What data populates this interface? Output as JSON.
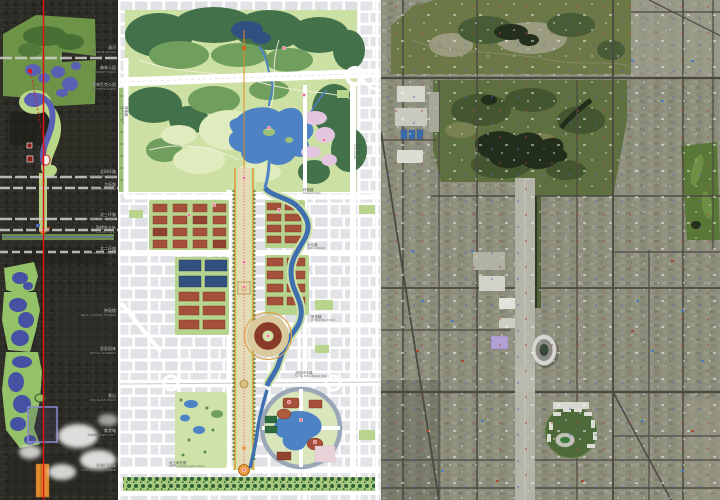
{
  "page": {
    "description": "Beijing central axis planning board: satellite axis strip, Olympic Green master plan, aerial photo"
  },
  "palette": {
    "axis_red": "#dd1414",
    "overlay_park_green": "#76a24c",
    "overlay_water_blue": "#5a61b5",
    "axis_corridor_green": "#b9d887",
    "plan_forest_green": "#42714a",
    "plan_lawn_green": "#cbe0a2",
    "plan_water_blue": "#4d82c4",
    "plan_building_red": "#a5503a",
    "plan_roof_navy": "#32507e",
    "blossom_pink": "#e2c5df",
    "axis_orange": "#e08a28",
    "stadium_ring_red": "#8a3a28",
    "tiananmen_square_orange": "#e08a2e",
    "forbidden_city_outline": "#8a8ad0",
    "satellite_park_green": "#5e6f40",
    "satellite_lake_dark": "#232d1c",
    "water_cube_purple": "#b2a2d4"
  },
  "left": {
    "name": "central axis satellite strip",
    "labels": [
      {
        "zh": "清河",
        "en": "QINGHE RIVER"
      },
      {
        "zh": "森林公园",
        "en": "FOREST PARK"
      },
      {
        "zh": "奥林匹克公园",
        "en": "OLYMPIC PARK"
      },
      {
        "zh": "北四环路",
        "en": "N.4TH RING ROAD"
      },
      {
        "zh": "北辰路",
        "en": "BEICHEN ROAD"
      },
      {
        "zh": "北三环路",
        "en": "N.3RD RING ROAD"
      },
      {
        "zh": "鼓楼外大街",
        "en": "GULOU AVE."
      },
      {
        "zh": "北二环路",
        "en": "N.2ND RING ROAD"
      },
      {
        "zh": "钟鼓楼",
        "en": "BELL & DRUM TOWER"
      },
      {
        "zh": "皇家园林",
        "en": "ROYAL GARDEN"
      },
      {
        "zh": "景山",
        "en": "JINGSHAN PARK"
      },
      {
        "zh": "紫禁城",
        "en": "FORBIDDEN CITY"
      },
      {
        "zh": "天安门广场",
        "en": "TIAN'ANMEN SQUARE"
      }
    ]
  },
  "middle": {
    "name": "Olympic Green master plan",
    "road_labels": [
      {
        "zh": "林萃路",
        "en": "LINCUI ROAD"
      },
      {
        "zh": "安立路",
        "en": "ANLI ROAD"
      },
      {
        "zh": "科荟路",
        "en": "KEHUI ROAD"
      },
      {
        "zh": "大屯路",
        "en": "DATUN ROAD"
      },
      {
        "zh": "慧忠路",
        "en": "HUIZHONG ROAD"
      },
      {
        "zh": "北四环中路",
        "en": "N.4TH RING ROAD (MID.)"
      },
      {
        "zh": "北土城东路",
        "en": "BEITUCHENG EAST ROAD"
      }
    ]
  },
  "right": {
    "name": "aerial satellite photo of Olympic Green"
  }
}
